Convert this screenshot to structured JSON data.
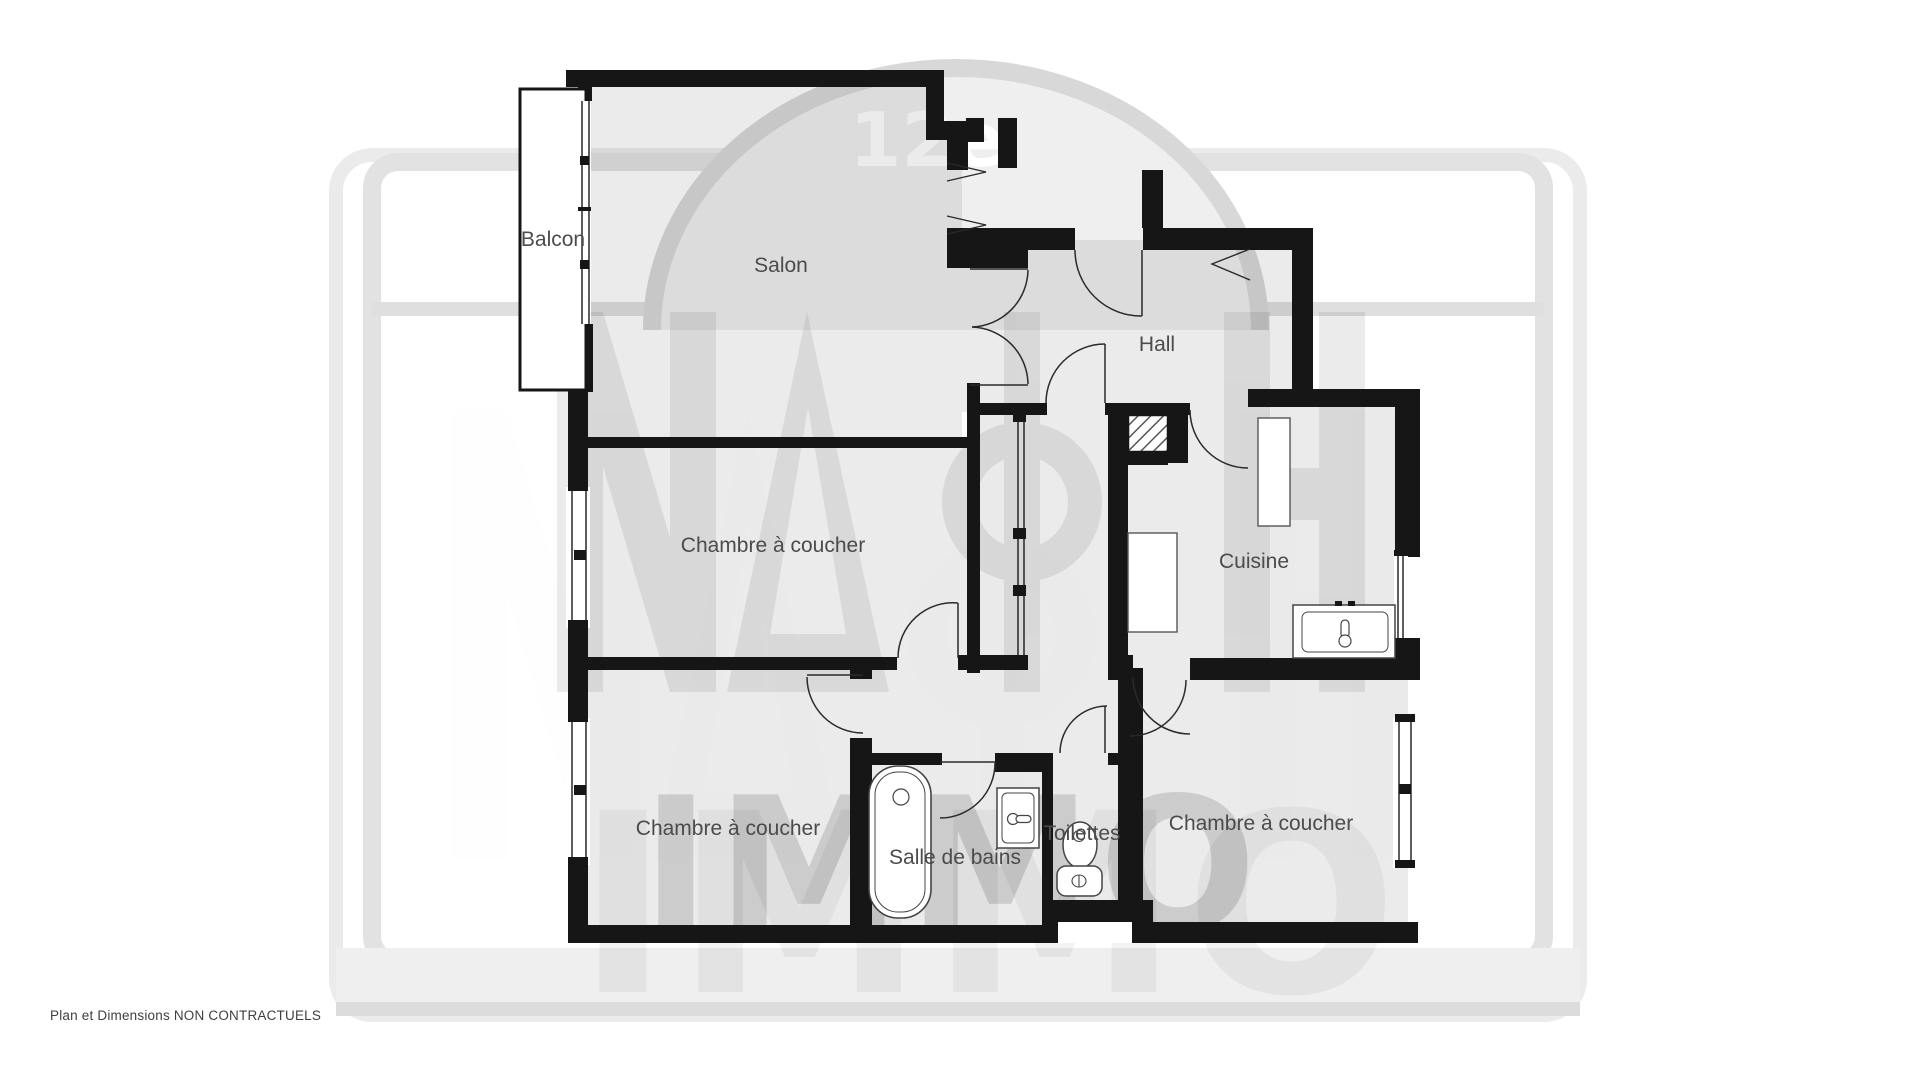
{
  "disclaimer": "Plan et Dimensions NON CONTRACTUELS",
  "watermark": {
    "district_badge": "12e",
    "brand": "NACH",
    "brand_suffix": "IMMO"
  },
  "rooms": [
    {
      "label": "Balcon"
    },
    {
      "label": "Salon"
    },
    {
      "label": "Hall"
    },
    {
      "label": "Chambre à coucher"
    },
    {
      "label": "Cuisine"
    },
    {
      "label": "Chambre à coucher"
    },
    {
      "label": "Salle de bains"
    },
    {
      "label": "Toilettes"
    },
    {
      "label": "Chambre à coucher"
    }
  ],
  "colors": {
    "wall": "#161616",
    "room_fill": "#e9e9e9",
    "watermark_gray": "#e2e2e2",
    "label_text": "#4b4b4b",
    "background": "#ffffff"
  }
}
